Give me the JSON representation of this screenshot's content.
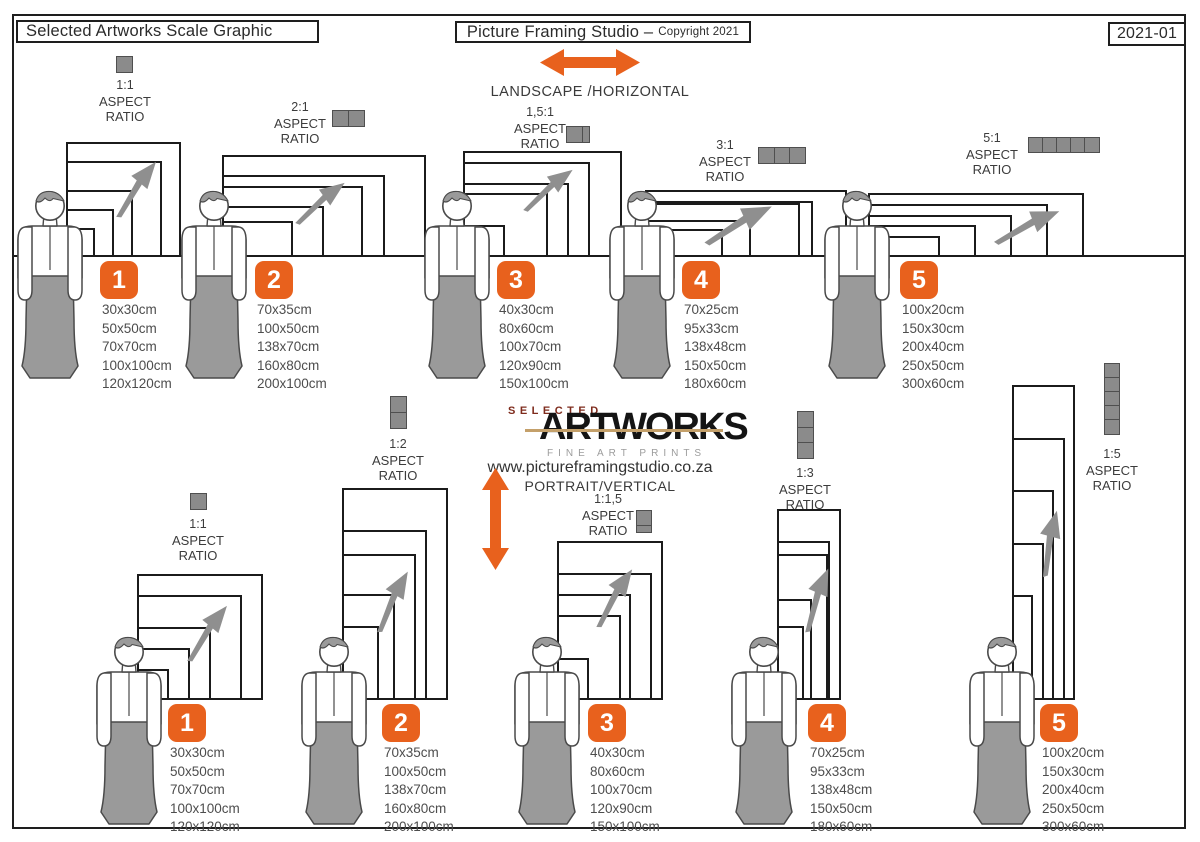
{
  "page": {
    "header_left": "Selected Artworks Scale Graphic",
    "header_center_title": "Picture Framing Studio –",
    "header_center_copyright": "Copyright 2021",
    "header_right": "2021-01"
  },
  "logo": {
    "top": "SELECTED",
    "main": "ARTWORKS",
    "sub": "FINE ART PRINTS",
    "website": "www.pictureframingstudio.co.za"
  },
  "aspect_words": [
    "ASPECT",
    "RATIO"
  ],
  "sections": {
    "landscape": {
      "title": "LANDSCAPE /HORIZONTAL",
      "groups": [
        {
          "number": "1",
          "ratio": "1:1",
          "icon_units": 1,
          "sizes": [
            "30x30cm",
            "50x50cm",
            "70x70cm",
            "100x100cm",
            "120x120cm"
          ]
        },
        {
          "number": "2",
          "ratio": "2:1",
          "icon_units": 2,
          "sizes": [
            "70x35cm",
            "100x50cm",
            "138x70cm",
            "160x80cm",
            "200x100cm"
          ]
        },
        {
          "number": "3",
          "ratio": "1,5:1",
          "icon_units": 1.5,
          "sizes": [
            "40x30cm",
            "80x60cm",
            "100x70cm",
            "120x90cm",
            "150x100cm"
          ]
        },
        {
          "number": "4",
          "ratio": "3:1",
          "icon_units": 3,
          "sizes": [
            "70x25cm",
            "95x33cm",
            "138x48cm",
            "150x50cm",
            "180x60cm"
          ]
        },
        {
          "number": "5",
          "ratio": "5:1",
          "icon_units": 5,
          "sizes": [
            "100x20cm",
            "150x30cm",
            "200x40cm",
            "250x50cm",
            "300x60cm"
          ]
        }
      ]
    },
    "portrait": {
      "title": "PORTRAIT/VERTICAL",
      "groups": [
        {
          "number": "1",
          "ratio": "1:1",
          "icon_units": 1,
          "sizes": [
            "30x30cm",
            "50x50cm",
            "70x70cm",
            "100x100cm",
            "120x120cm"
          ]
        },
        {
          "number": "2",
          "ratio": "1:2",
          "icon_units": 2,
          "sizes": [
            "70x35cm",
            "100x50cm",
            "138x70cm",
            "160x80cm",
            "200x100cm"
          ]
        },
        {
          "number": "3",
          "ratio": "1:1,5",
          "icon_units": 1.5,
          "sizes": [
            "40x30cm",
            "80x60cm",
            "100x70cm",
            "120x90cm",
            "150x100cm"
          ]
        },
        {
          "number": "4",
          "ratio": "1:3",
          "icon_units": 3,
          "sizes": [
            "70x25cm",
            "95x33cm",
            "138x48cm",
            "150x50cm",
            "180x60cm"
          ]
        },
        {
          "number": "5",
          "ratio": "1:5",
          "icon_units": 5,
          "sizes": [
            "100x20cm",
            "150x30cm",
            "200x40cm",
            "250x50cm",
            "300x60cm"
          ]
        }
      ]
    }
  },
  "colors": {
    "accent": "#E8611D",
    "frame_line": "#1b1b1b",
    "icon_gray": "#8B8B8B",
    "figure_gray": "#9A9A9A"
  }
}
